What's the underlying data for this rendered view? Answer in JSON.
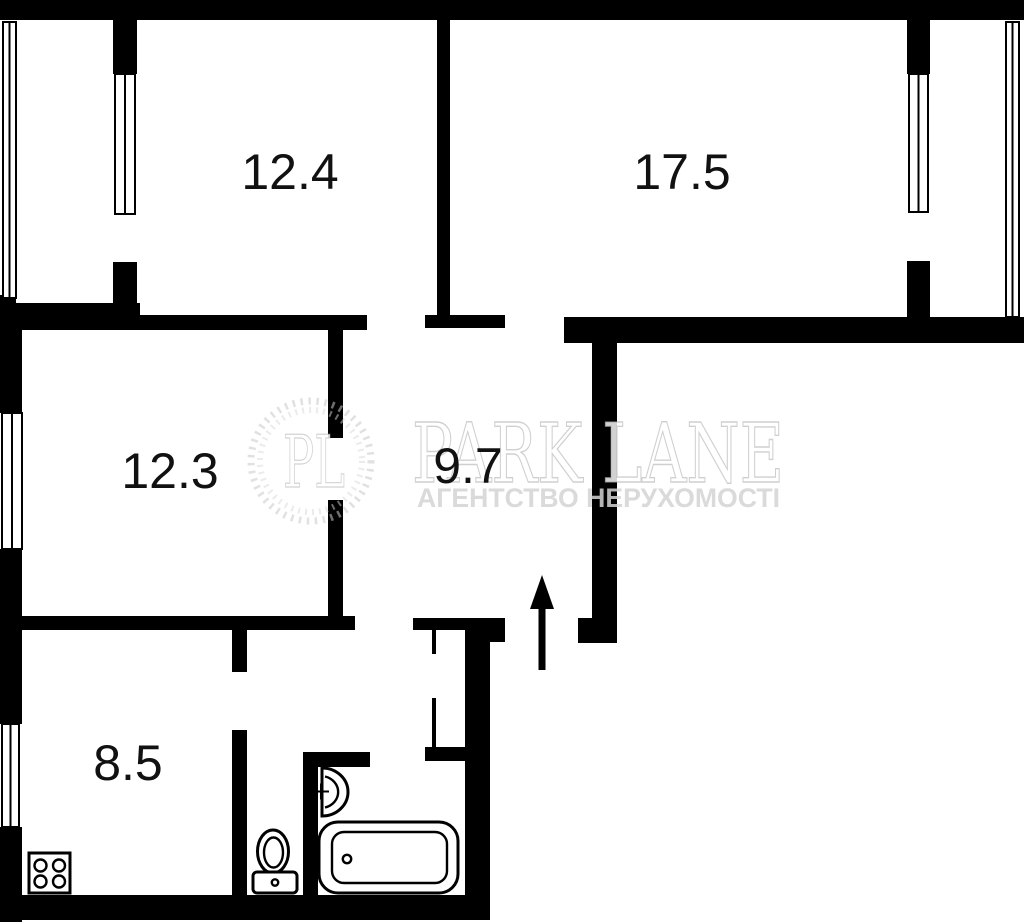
{
  "colors": {
    "wall": "#000000",
    "background": "#ffffff",
    "label_text": "#111111",
    "watermark_gray": "#e3e3e3"
  },
  "rooms": [
    {
      "id": "room-top-left",
      "area_label": "12.4"
    },
    {
      "id": "room-top-right",
      "area_label": "17.5"
    },
    {
      "id": "room-middle-left",
      "area_label": "12.3"
    },
    {
      "id": "hallway",
      "area_label": "9.7"
    },
    {
      "id": "kitchen",
      "area_label": "8.5"
    }
  ],
  "watermark": {
    "monogram": "PL",
    "brand": "PARK LANE",
    "tagline": "АГЕНТСТВО НЕРУХОМОСТІ"
  },
  "fixtures": [
    "stove-icon",
    "toilet-icon",
    "sink-icon",
    "bathtub-icon",
    "entrance-arrow-icon"
  ]
}
